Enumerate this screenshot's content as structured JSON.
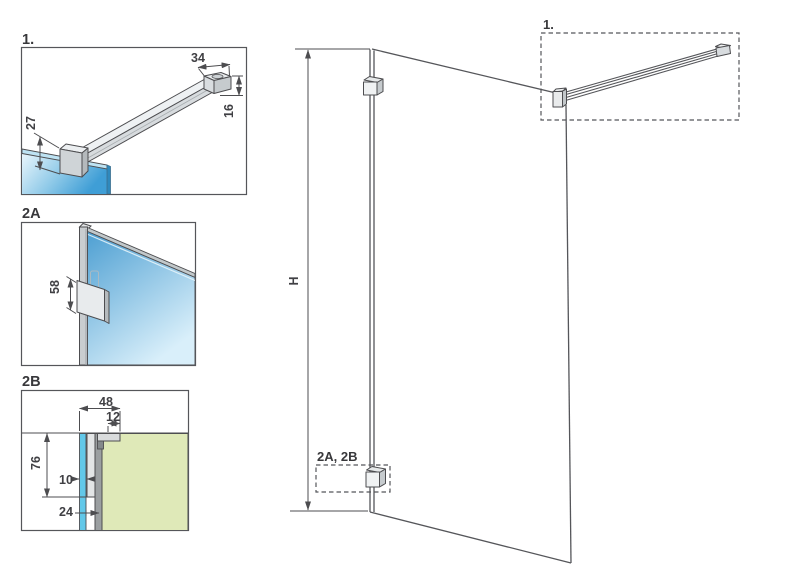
{
  "figure": {
    "kind": "technical installation diagram",
    "subject": "walk-in shower glass panel with wall support bar and wall profile details"
  },
  "colors": {
    "line": "#4d4d50",
    "glass_blue_light": "#eaf6fc",
    "glass_blue_deep": "#3f9ed6",
    "glass_edge_blue": "#2f89bd",
    "glass_top_band": "#bee3f3",
    "glass2a_dark": "#4d9fd2",
    "glass2a_light": "#d9effa",
    "glass_strip_cyan": "#62c8e9",
    "wall_green": "#dfe9b8",
    "metal_light": "#e8ebed",
    "metal_mid": "#cfd4d7",
    "metal_dark": "#9b9fa1"
  },
  "details": {
    "support_bar": {
      "label": "1.",
      "dim_wall_plate_width": "34",
      "dim_bar_height": "16",
      "dim_clamp_height": "27"
    },
    "wall_bracket_front": {
      "label": "2A",
      "dim_bracket_height": "58"
    },
    "wall_profile_section": {
      "label": "2B",
      "dim_total_depth": "48",
      "dim_arm_depth": "12",
      "dim_bracket_plate_height": "76",
      "dim_glass_thickness": "10",
      "dim_profile_depth": "24"
    }
  },
  "main_view": {
    "height_dim_label": "H",
    "callout_support_bar": "1.",
    "callout_wall_profile": "2A, 2B"
  }
}
